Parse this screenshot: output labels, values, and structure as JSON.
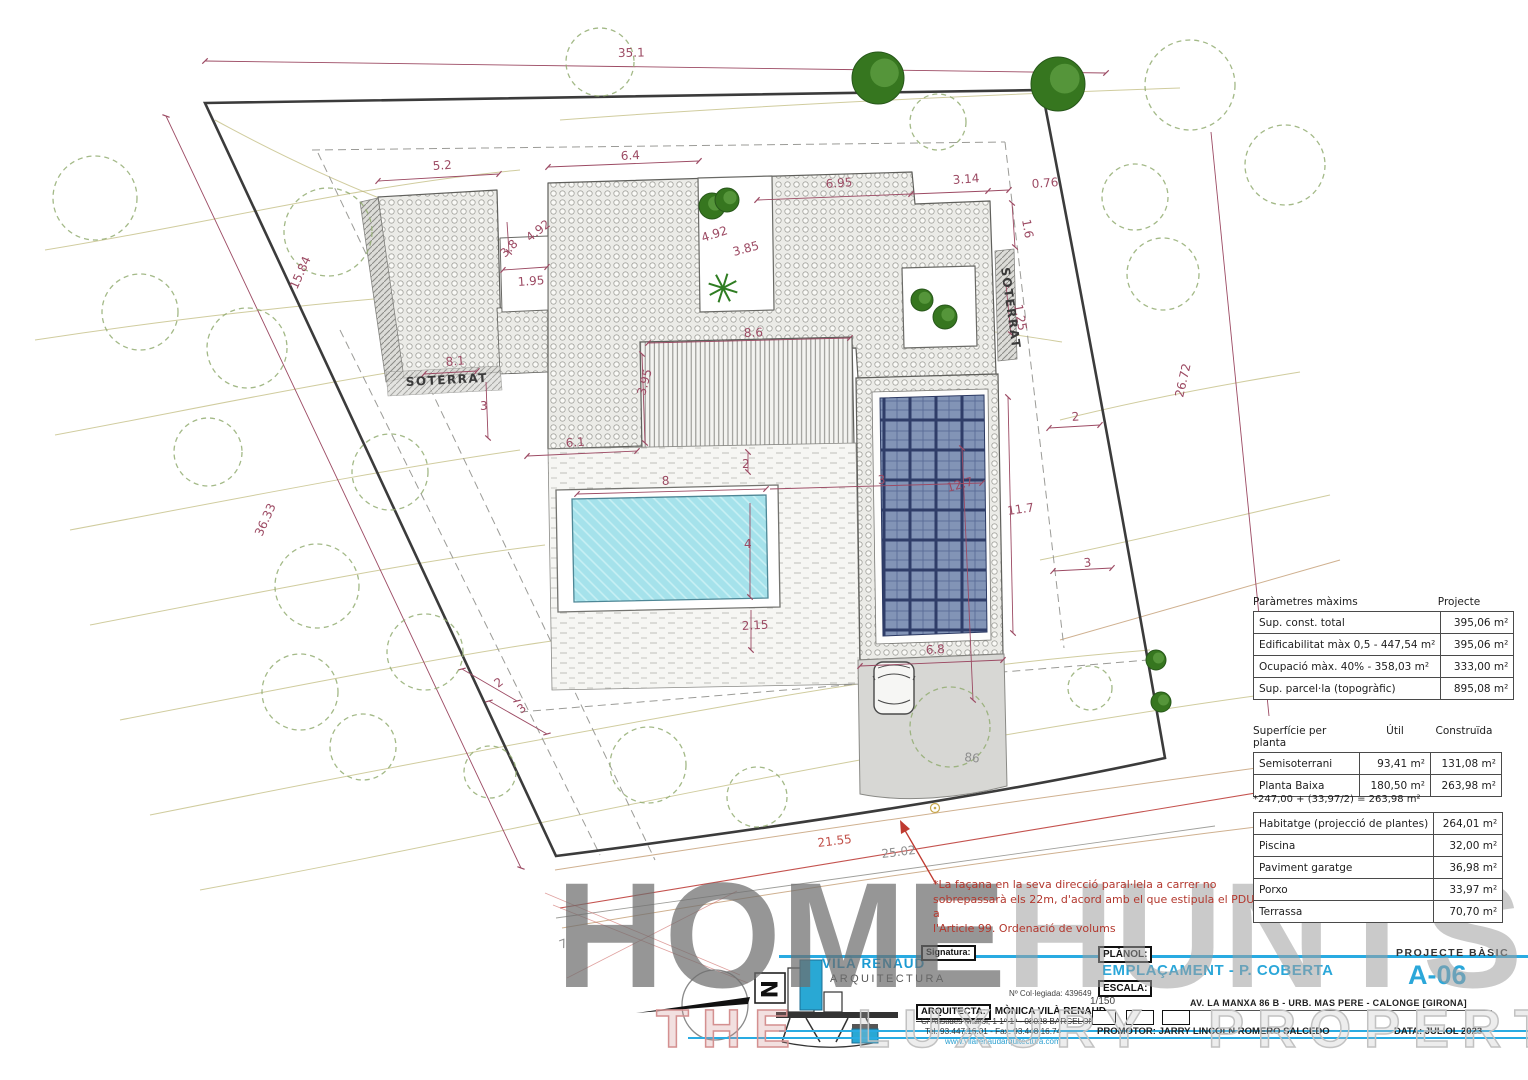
{
  "tables": {
    "parametres": {
      "header": [
        "Paràmetres màxims",
        "Projecte"
      ],
      "rows": [
        [
          "Sup. const. total",
          "395,06 m²"
        ],
        [
          "Edificabilitat màx 0,5 - 447,54 m²",
          "395,06 m²"
        ],
        [
          "Ocupació màx. 40% - 358,03 m²",
          "333,00 m²"
        ],
        [
          "Sup. parcel·la (topogràfic)",
          "895,08 m²"
        ]
      ]
    },
    "superficie": {
      "header": [
        "Superfície per planta",
        "Útil",
        "Construïda"
      ],
      "rows": [
        [
          "Semisoterrani",
          "93,41 m²",
          "131,08 m²"
        ],
        [
          "Planta Baixa",
          "180,50 m²",
          "263,98 m²"
        ]
      ],
      "note": "*247,00 + (33,97/2) = 263,98 m²"
    },
    "exterior": {
      "rows": [
        [
          "Habitatge (projecció de plantes)",
          "264,01 m²"
        ],
        [
          "Piscina",
          "32,00 m²"
        ],
        [
          "Paviment garatge",
          "36,98 m²"
        ],
        [
          "Porxo",
          "33,97 m²"
        ],
        [
          "Terrassa",
          "70,70 m²"
        ]
      ]
    }
  },
  "annotation": {
    "lines": [
      "*La façana en la seva direcció paral·lela a carrer no",
      "sobrepassarà els 22m, d'acord amb el que estipula el PDU  a",
      "l'Article 99. Ordenació de volums"
    ]
  },
  "plan": {
    "labels": [
      {
        "text": "35.1",
        "x": 618,
        "y": 57,
        "rot": -1
      },
      {
        "text": "36.33",
        "x": 262,
        "y": 537,
        "rot": -66
      },
      {
        "text": "15.84",
        "x": 297,
        "y": 290,
        "rot": -66
      },
      {
        "text": "26.72",
        "x": 1183,
        "y": 398,
        "rot": -77
      },
      {
        "text": "5.2",
        "x": 433,
        "y": 170,
        "rot": -4
      },
      {
        "text": "6.4",
        "x": 621,
        "y": 160,
        "rot": -3
      },
      {
        "text": "6.95",
        "x": 826,
        "y": 188,
        "rot": -4
      },
      {
        "text": "3.14",
        "x": 953,
        "y": 184,
        "rot": -4
      },
      {
        "text": "0.76",
        "x": 1032,
        "y": 188,
        "rot": -4
      },
      {
        "text": "1.6",
        "x": 1022,
        "y": 220,
        "rot": 80
      },
      {
        "text": "1.25",
        "x": 1014,
        "y": 305,
        "rot": 80
      },
      {
        "text": "4.92",
        "x": 530,
        "y": 242,
        "rot": -38
      },
      {
        "text": "3.8",
        "x": 505,
        "y": 258,
        "rot": -45
      },
      {
        "text": "1.95",
        "x": 518,
        "y": 286,
        "rot": -4
      },
      {
        "text": "4.92",
        "x": 703,
        "y": 242,
        "rot": -18
      },
      {
        "text": "3.85",
        "x": 734,
        "y": 256,
        "rot": -15
      },
      {
        "text": "8.1",
        "x": 446,
        "y": 366,
        "rot": -5,
        "fs": 10
      },
      {
        "text": "3",
        "x": 480,
        "y": 410,
        "rot": 0
      },
      {
        "text": "8.6",
        "x": 744,
        "y": 337,
        "rot": -2
      },
      {
        "text": "3.95",
        "x": 645,
        "y": 396,
        "rot": -75
      },
      {
        "text": "6.1",
        "x": 566,
        "y": 447,
        "rot": -4
      },
      {
        "text": "2",
        "x": 742,
        "y": 468,
        "rot": 0
      },
      {
        "text": "8",
        "x": 662,
        "y": 485,
        "rot": -3
      },
      {
        "text": "3",
        "x": 878,
        "y": 484,
        "rot": -3
      },
      {
        "text": "12.7",
        "x": 948,
        "y": 492,
        "rot": -15
      },
      {
        "text": "4",
        "x": 744,
        "y": 548,
        "rot": 0
      },
      {
        "text": "2.15",
        "x": 742,
        "y": 630,
        "rot": -3
      },
      {
        "text": "11.7",
        "x": 1008,
        "y": 515,
        "rot": -8
      },
      {
        "text": "6.8",
        "x": 926,
        "y": 654,
        "rot": -3
      },
      {
        "text": "2",
        "x": 498,
        "y": 688,
        "rot": -37
      },
      {
        "text": "3",
        "x": 521,
        "y": 714,
        "rot": -37
      },
      {
        "text": "2",
        "x": 1072,
        "y": 421,
        "rot": -5
      },
      {
        "text": "3",
        "x": 1084,
        "y": 567,
        "rot": -5
      },
      {
        "text": "21.55",
        "x": 818,
        "y": 847,
        "rot": -7,
        "cls": "red",
        "fs": 13
      },
      {
        "text": "25.02",
        "x": 882,
        "y": 858,
        "rot": -7,
        "cls": "gray",
        "fs": 12
      },
      {
        "text": "86",
        "x": 964,
        "y": 761,
        "rot": 6,
        "cls": "gray",
        "fs": 15
      },
      {
        "text": "7",
        "x": 561,
        "y": 949,
        "rot": -20,
        "cls": "gray",
        "fs": 12
      },
      {
        "text": "SOTERRAT",
        "x": 406,
        "y": 386,
        "rot": -3,
        "cls": "sot",
        "fs": 11
      },
      {
        "text": "SOTERRAT",
        "x": 1001,
        "y": 268,
        "rot": 82,
        "cls": "sot",
        "fs": 9
      }
    ],
    "trees": [
      {
        "x": 600,
        "y": 62,
        "r": 34,
        "kind": "sketch"
      },
      {
        "x": 938,
        "y": 122,
        "r": 28,
        "kind": "sketch"
      },
      {
        "x": 1190,
        "y": 85,
        "r": 45,
        "kind": "sketch"
      },
      {
        "x": 1285,
        "y": 165,
        "r": 40,
        "kind": "sketch"
      },
      {
        "x": 1135,
        "y": 197,
        "r": 33,
        "kind": "sketch"
      },
      {
        "x": 1163,
        "y": 274,
        "r": 36,
        "kind": "sketch"
      },
      {
        "x": 95,
        "y": 198,
        "r": 42,
        "kind": "sketch"
      },
      {
        "x": 140,
        "y": 312,
        "r": 38,
        "kind": "sketch"
      },
      {
        "x": 328,
        "y": 232,
        "r": 44,
        "kind": "sketch"
      },
      {
        "x": 247,
        "y": 348,
        "r": 40,
        "kind": "sketch"
      },
      {
        "x": 208,
        "y": 452,
        "r": 34,
        "kind": "sketch"
      },
      {
        "x": 390,
        "y": 472,
        "r": 38,
        "kind": "sketch"
      },
      {
        "x": 317,
        "y": 586,
        "r": 42,
        "kind": "sketch"
      },
      {
        "x": 425,
        "y": 652,
        "r": 38,
        "kind": "sketch"
      },
      {
        "x": 300,
        "y": 692,
        "r": 38,
        "kind": "sketch"
      },
      {
        "x": 363,
        "y": 747,
        "r": 33,
        "kind": "sketch"
      },
      {
        "x": 648,
        "y": 765,
        "r": 38,
        "kind": "sketch"
      },
      {
        "x": 757,
        "y": 797,
        "r": 30,
        "kind": "sketch"
      },
      {
        "x": 950,
        "y": 727,
        "r": 40,
        "kind": "sketch"
      },
      {
        "x": 1090,
        "y": 688,
        "r": 22,
        "kind": "sketch"
      },
      {
        "x": 490,
        "y": 772,
        "r": 26,
        "kind": "sketch"
      },
      {
        "x": 878,
        "y": 78,
        "r": 26,
        "kind": "solid"
      },
      {
        "x": 1058,
        "y": 84,
        "r": 27,
        "kind": "solid"
      },
      {
        "x": 712,
        "y": 206,
        "r": 13,
        "kind": "solid"
      },
      {
        "x": 727,
        "y": 200,
        "r": 12,
        "kind": "solid"
      },
      {
        "x": 922,
        "y": 300,
        "r": 11,
        "kind": "shrub"
      },
      {
        "x": 945,
        "y": 317,
        "r": 12,
        "kind": "shrub"
      },
      {
        "x": 1156,
        "y": 660,
        "r": 10,
        "kind": "shrub"
      },
      {
        "x": 1161,
        "y": 702,
        "r": 10,
        "kind": "shrub"
      },
      {
        "x": 723,
        "y": 288,
        "r": 15,
        "kind": "palm"
      }
    ]
  },
  "titleblock": {
    "north_letter": "N",
    "firm_name": "VILÀ RENAUD",
    "firm_sub": "ARQUITECTURA",
    "signature_label": "Signatura:",
    "collegiate": "Nº Col·legiada: 439649",
    "architect_label": "ARQUITECTA:",
    "architect_name": "MÒNICA VILÀ RENAUD",
    "address": "C/ Aristides Maillol, 1 1º-1ª - 08028 BARCELONA",
    "phone": "Tel. 93.447.16.01 - Fax. 93.448.16.74",
    "website": "www.vilarenaudarquitectura.com",
    "planol_label": "PLÀNOL:",
    "planol_value": "EMPLAÇAMENT - P. COBERTA",
    "escala_label": "ESCALA:",
    "escala_value": "1/150",
    "project_type": "PROJECTE BÀSIC",
    "sheet_number": "A-06",
    "site_address": "AV. LA MANXA 86 B - URB. MAS PERE - CALONGE [GIRONA]",
    "promotor": "PROMOTOR: JARRY LINCOLN ROMERO SALCEDO",
    "data": "DATA: JULIOL 2023"
  },
  "watermark": {
    "part1": "HOME",
    "part2": "HUNTS",
    "line2_a": "THE",
    "line2_b": "LUXURY PROPERTY FINDERS"
  },
  "colors": {
    "accent": "#29abe2",
    "dim": "#9c4a63",
    "note_red": "#b3382e",
    "pool": "#a5e2eb"
  }
}
